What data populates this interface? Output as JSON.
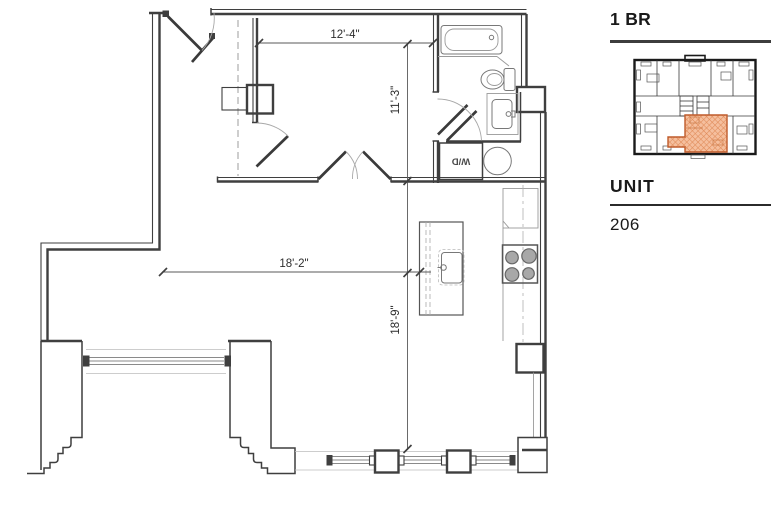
{
  "sidebar": {
    "plan_type_label": "1 BR",
    "unit_heading": "UNIT",
    "unit_number": "206"
  },
  "floorplan": {
    "dim_bedroom_width": "12'-4\"",
    "dim_bedroom_depth": "11'-3\"",
    "dim_living_width": "18'-2\"",
    "dim_living_depth": "18'-9\"",
    "washer_dryer_label": "W/D"
  },
  "keyplan": {
    "description": "building key plan with highlighted unit",
    "highlight_fill": "#f5bf9e",
    "highlight_hatch": "#e08a58",
    "highlight_outline": "#bf5b2b"
  },
  "colors": {
    "wall": "#3f3f3f",
    "dimension_text": "#2d2d2d",
    "divider": "#3d3d3d"
  }
}
